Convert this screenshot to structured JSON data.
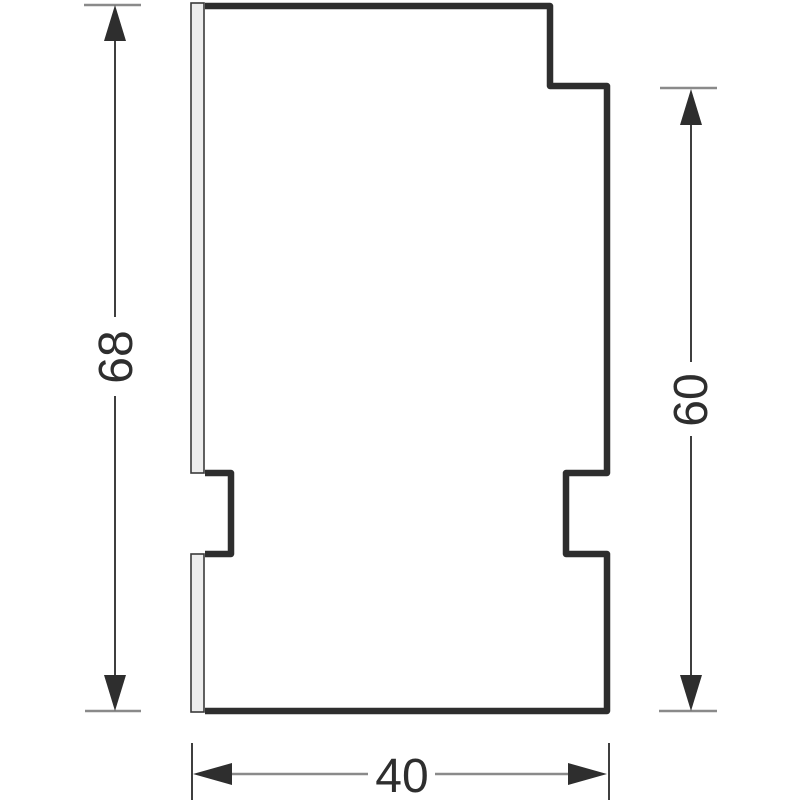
{
  "drawing": {
    "kind": "dimensioned-side-profile",
    "labels": {
      "overall_height": "68",
      "right_height": "60",
      "width": "40"
    },
    "colors": {
      "outline": "#2e2e2e",
      "arrow": "#2e2e2e",
      "flange_fill": "#ededed",
      "flange_stroke": "#3a3a3a",
      "dimension_line_vertical": "#3f3f3f",
      "dimension_line_horizontal": "#8a8a8a",
      "text": "#2e2e2e",
      "background": "#ffffff"
    }
  }
}
